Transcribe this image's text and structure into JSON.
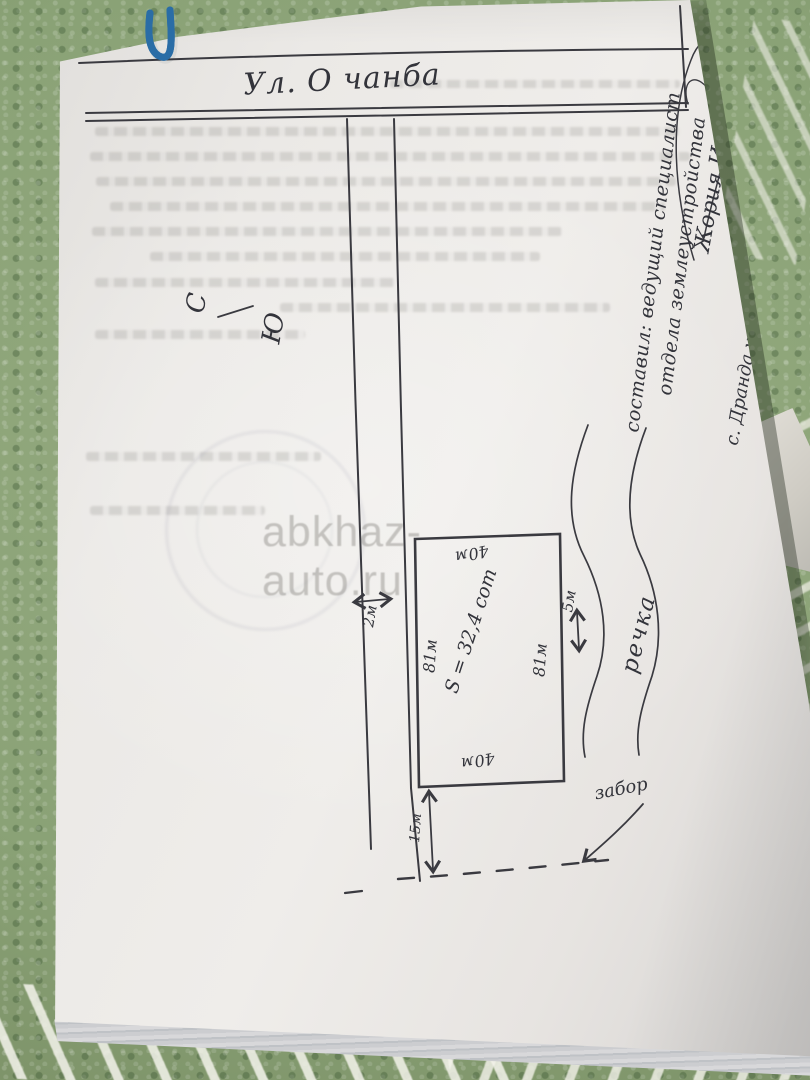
{
  "watermark": {
    "text": "abkhaz-auto.ru"
  },
  "plan": {
    "street_label": "Ул. О чанба",
    "compass": {
      "north": "С",
      "south": "Ю"
    },
    "road_width_label": "2м",
    "plot": {
      "top_label": "40м",
      "bottom_label": "40м",
      "left_label": "81м",
      "right_label": "81м",
      "area_label": "S = 32,4 сот"
    },
    "offset_river_label": "5м",
    "offset_fence_label": "15м",
    "river_label": "речка",
    "fence_label": "забор"
  },
  "notes": {
    "line1": "составил: ведущий специалист",
    "line2": "отдела землеустройства",
    "line3": "Жория И.",
    "line4": "с. Дранда ул. О.чанба"
  }
}
